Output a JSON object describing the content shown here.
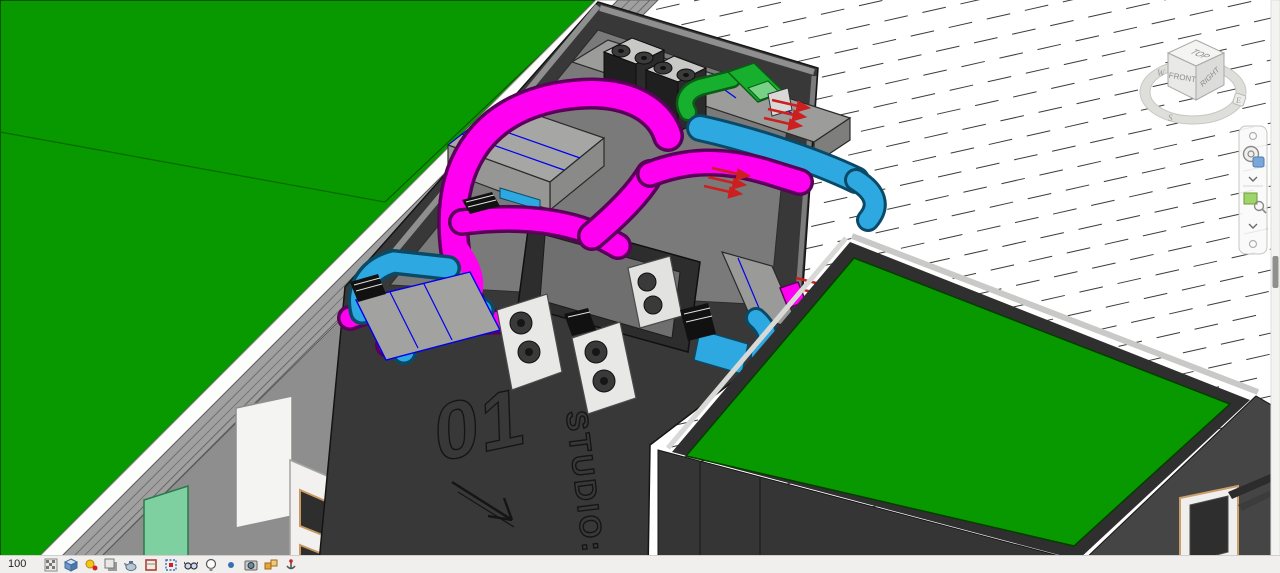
{
  "facade": {
    "unit_number": "01",
    "studio_label": "STUDIO: P"
  },
  "viewcube": {
    "top": "TOP",
    "front": "FRONT",
    "right": "RIGHT",
    "compass_west": "W",
    "compass_south": "S",
    "compass_east": "E"
  },
  "navigation_bar": {
    "buttons": [
      {
        "name": "full-navigation-wheel"
      },
      {
        "name": "wheel-options-dropdown"
      },
      {
        "name": "zoom-region"
      },
      {
        "name": "zoom-options-dropdown"
      }
    ]
  },
  "view_control_bar": {
    "scale_label": "100",
    "buttons": [
      {
        "name": "detail-level"
      },
      {
        "name": "visual-style"
      },
      {
        "name": "sun-path"
      },
      {
        "name": "shadows"
      },
      {
        "name": "rendering-dialog"
      },
      {
        "name": "crop-view"
      },
      {
        "name": "show-crop-region"
      },
      {
        "name": "temporary-hide-isolate"
      },
      {
        "name": "reveal-hidden-elements"
      },
      {
        "name": "temporary-view-properties"
      },
      {
        "name": "show-analytical-model"
      },
      {
        "name": "highlight-displacement-sets"
      },
      {
        "name": "reveal-constraints"
      }
    ]
  },
  "colors": {
    "roof_green": "#089800",
    "glass_green": "#7fd0a0",
    "duct_magenta": "#ff00f0",
    "duct_cyan": "#2ea8e0",
    "duct_green": "#17b02e",
    "flow_arrow_red": "#cc1f1f",
    "building_dark": "#383838",
    "facade_gray": "#a0a0a0"
  }
}
